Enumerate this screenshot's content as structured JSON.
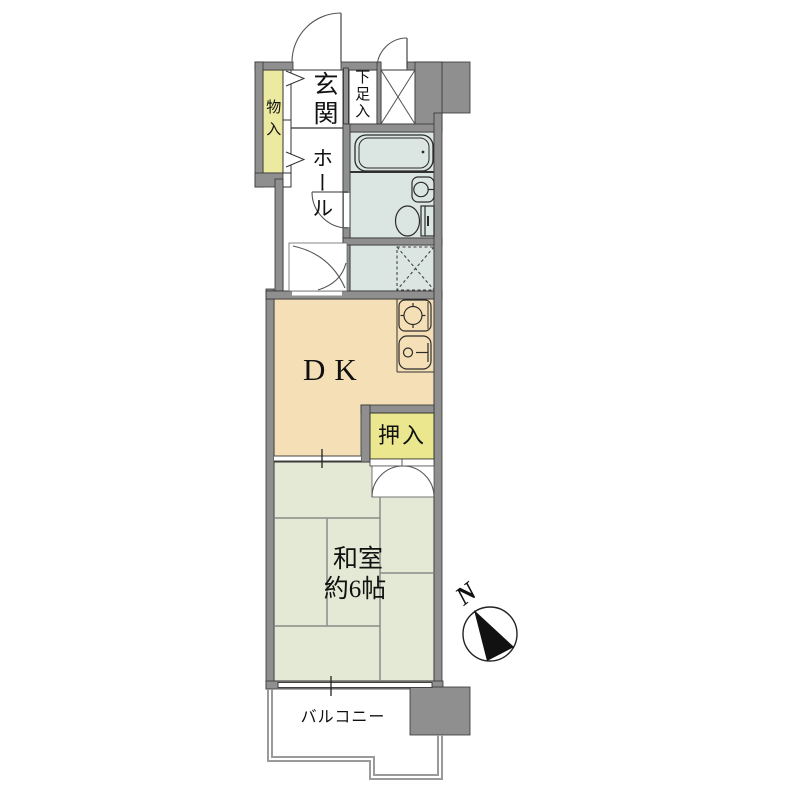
{
  "floor_plan": {
    "title": "Japanese 1DK apartment floor plan",
    "rooms": {
      "genkan": "玄関",
      "shoe_cupboard": "下足入",
      "storage": "物入",
      "hall": "ホール",
      "dining_kitchen": "DK",
      "closet": "押入",
      "japanese_room": "和室",
      "japanese_room_size": "約6帖",
      "balcony": "バルコニー"
    },
    "compass": {
      "label": "N",
      "direction": "needle points upper-left"
    },
    "fixtures": [
      "bathtub-icon",
      "washbasin-icon",
      "toilet-icon",
      "washer-pan-icon",
      "stove-icon",
      "kitchen-sink-icon",
      "pipe-space-x-icon",
      "door-swing-arcs"
    ],
    "colors": {
      "wall": "#8f8f8f",
      "outline": "#333333",
      "dk_floor": "#f5dfb6",
      "tatami_floor": "#e3e9d5",
      "bath_floor": "#dbe5e1",
      "storage_yellow": "#ece9a0",
      "closet_yellow": "#ebe78f",
      "railing_gray": "#9a9a9a"
    }
  }
}
